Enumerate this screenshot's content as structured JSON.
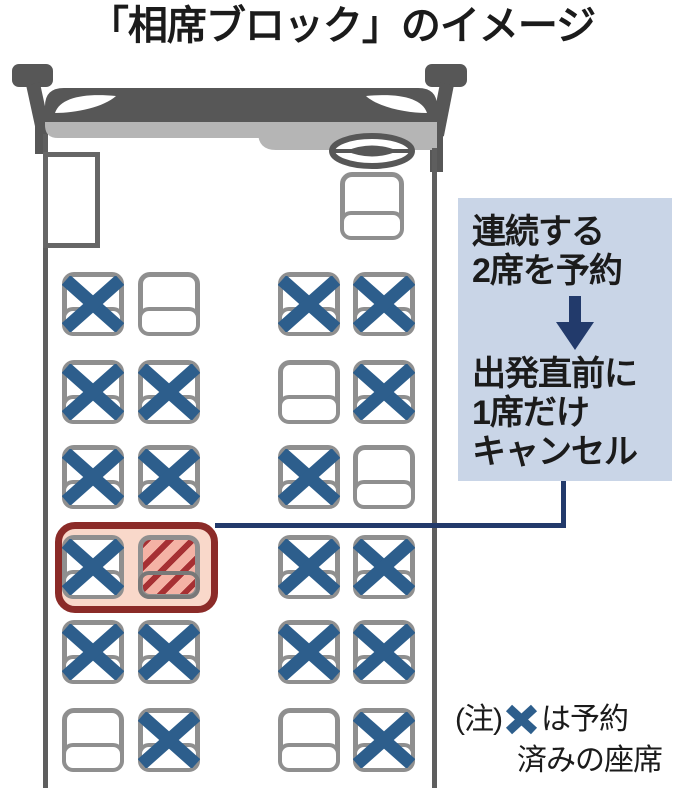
{
  "title": "「相席ブロック」のイメージ",
  "callout": {
    "step1_line1": "連続する",
    "step1_line2": "2席を予約",
    "step2_line1": "出発直前に",
    "step2_line2": "1席だけ",
    "step2_line3": "キャンセル"
  },
  "note": {
    "prefix": "(注)",
    "after_icon": "は予約",
    "line2": "済みの座席"
  },
  "seat_map": {
    "rows": [
      [
        "reserved",
        "empty",
        "reserved",
        "reserved"
      ],
      [
        "reserved",
        "reserved",
        "empty",
        "reserved"
      ],
      [
        "reserved",
        "reserved",
        "reserved",
        "empty"
      ],
      [
        "reserved",
        "canceled",
        "reserved",
        "reserved"
      ],
      [
        "reserved",
        "reserved",
        "reserved",
        "reserved"
      ],
      [
        "empty",
        "reserved",
        "empty",
        "reserved"
      ]
    ],
    "highlight_block": {
      "row_index": 3,
      "col_indexes": [
        0,
        1
      ]
    }
  },
  "colors": {
    "bus_body": "#575757",
    "dashboard": "#b5b5b5",
    "wall": "#5e5e5e",
    "door_border": "#666666",
    "seat_border": "#8f8f8f",
    "x_mark": "#2d5e8c",
    "annotation_bg": "#c9d5e7",
    "navy": "#223a6b",
    "highlight_border": "#8b2b28",
    "highlight_fill": "#f9d8ca",
    "hatch_bg": "#f4b2a5",
    "hatch_stripe": "#a63033",
    "ink": "#1b1b1b"
  }
}
